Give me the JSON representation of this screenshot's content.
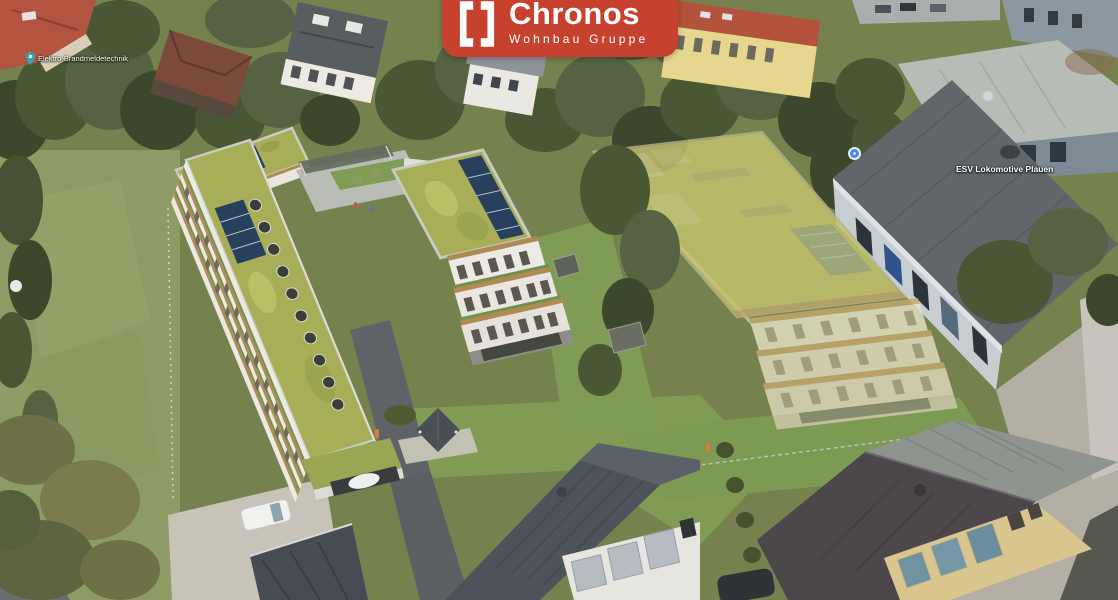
{
  "logo": {
    "brand": "Chronos",
    "tagline": "Wohnbau Gruppe",
    "bg_color": "#c7412f",
    "text_color": "#ffffff",
    "icon": "bracket-frame-icon"
  },
  "map_labels": {
    "business_left": "Elektro-Brandmeldetechnik",
    "business_right": "ESV Lokomotive Plauen"
  },
  "scene": {
    "type": "aerial-architectural-rendering",
    "colors": {
      "green_roof": "#a8ae57",
      "ghost_building_yellow": "#c6c36e",
      "grass": "#7f9b55",
      "asphalt": "#5b6063",
      "industrial_roof_gray": "#60666a",
      "wood_accent": "#ad8a57"
    }
  }
}
